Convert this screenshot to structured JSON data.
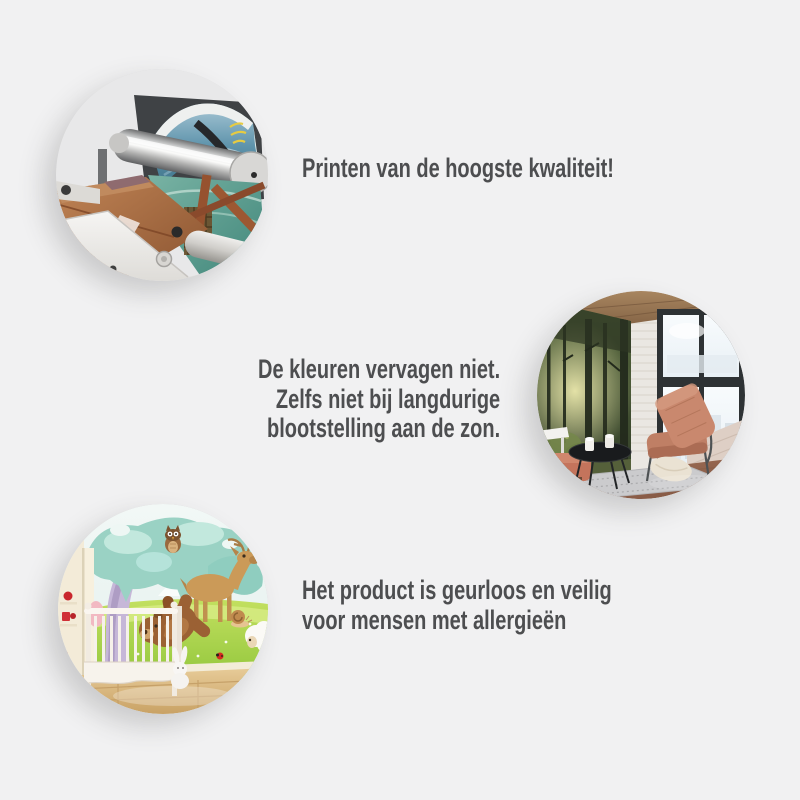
{
  "page": {
    "background_color": "#f1f1f2",
    "text_color": "#4d4e50",
    "shadow_color": "rgba(70,70,70,0.22)"
  },
  "features": [
    {
      "id": "print-quality",
      "image": "printing-machine-photo",
      "image_position": "left",
      "text": "Printen van de hoogste kwaliteit!"
    },
    {
      "id": "fade-resistant",
      "image": "living-room-forest-mural-photo",
      "image_position": "right",
      "text": "De kleuren vervagen niet.\nZelfs niet bij langdurige\nblootstelling aan de zon."
    },
    {
      "id": "allergy-safe",
      "image": "nursery-cartoon-mural-photo",
      "image_position": "left",
      "text": "Het product is geurloos en veilig\nvoor mensen met allergieën"
    }
  ]
}
